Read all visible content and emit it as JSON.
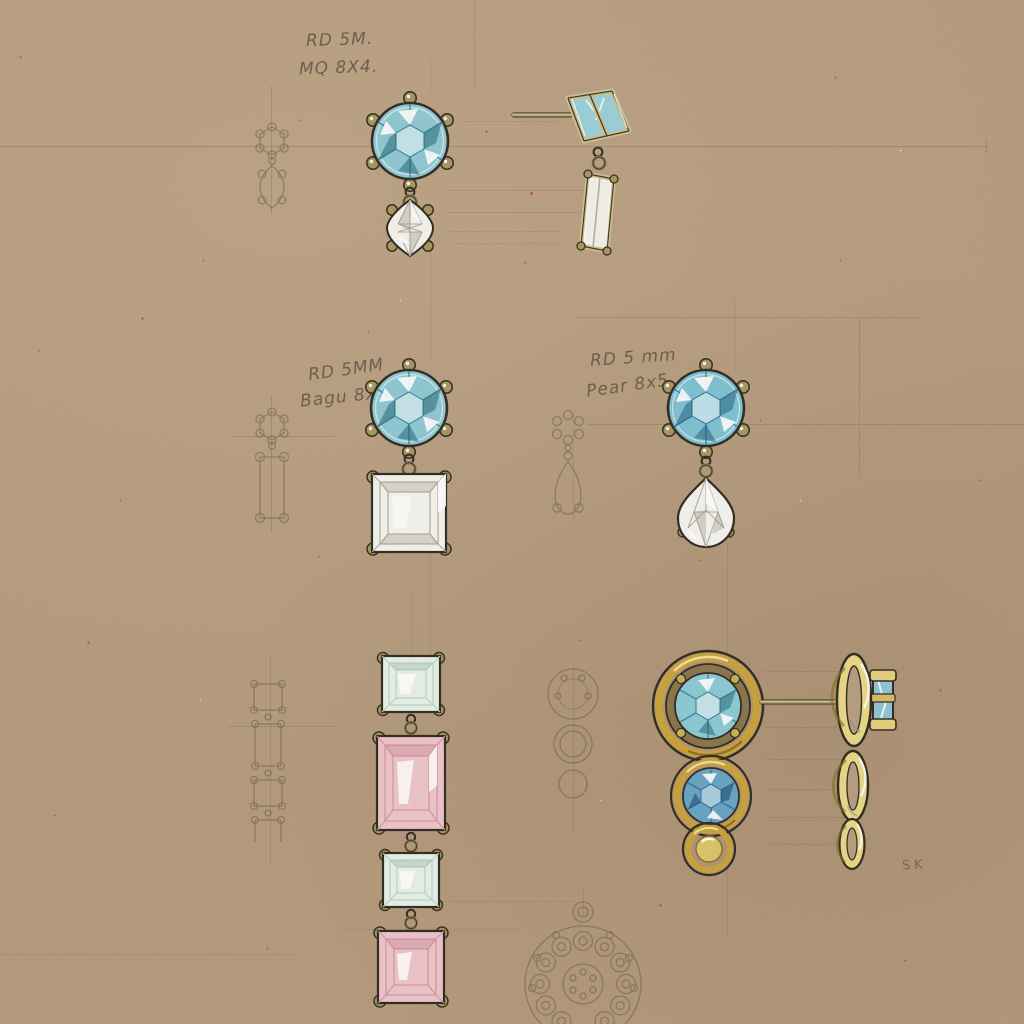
{
  "document": {
    "type": "Hand-painted jewellery earring design sheet on kraft paper",
    "medium": "pencil, ink and gouache"
  },
  "colors": {
    "paper": "#b69b7d",
    "pencil": "#5f584c",
    "ink_outline": "#2e2b23",
    "aquamarine": "#8fc9d4",
    "aquamarine_dark": "#2e7b8e",
    "diamond_white": "#f5f4ef",
    "diamond_shadow": "#b0aea2",
    "metal_khaki": "#a79762",
    "gold": "#caa23c",
    "gold_light": "#f0df9a",
    "pink_baguette": "#eec5cb",
    "mint_square": "#e7f2ea",
    "blue_topaz": "#66a4c4",
    "citrine": "#ddc56c"
  },
  "annotations": {
    "design1": {
      "line1": "RD 5M.",
      "line2": "MQ 8X4."
    },
    "design2": {
      "line1": "RD 5MM",
      "line2": "Bagu 8x4"
    },
    "design3": {
      "line1": "RD 5 mm",
      "line2": "Pear 8x5"
    },
    "signature": "SK"
  },
  "designs": [
    {
      "id": "round-marquise-drop",
      "stones": [
        "5mm round aquamarine stud",
        "8x4 marquise diamond drop"
      ],
      "views": [
        "pencil thumbnail",
        "painted front",
        "painted side"
      ]
    },
    {
      "id": "round-baguette-drop",
      "stones": [
        "5mm round aquamarine stud",
        "8x4 baguette diamond drop"
      ],
      "views": [
        "pencil thumbnail",
        "painted front"
      ]
    },
    {
      "id": "round-pear-drop",
      "stones": [
        "5mm round aquamarine stud",
        "8x5 pear diamond drop"
      ],
      "views": [
        "pencil thumbnail",
        "painted front"
      ]
    },
    {
      "id": "carre-and-pink-baguette-line-drop",
      "stones": [
        "carre step-cut",
        "pink baguette",
        "carre step-cut",
        "pink baguette"
      ],
      "views": [
        "pencil thumbnail",
        "painted front"
      ]
    },
    {
      "id": "graduated-gold-bezel-circles",
      "stones": [
        "aquamarine in double gold halo",
        "blue topaz in gold bezel",
        "gold bead"
      ],
      "views": [
        "pencil thumbnail",
        "painted front",
        "painted side"
      ]
    },
    {
      "id": "round-cluster-pendant",
      "stones": [
        "centre stone with halo of round bezels"
      ],
      "views": [
        "pencil sketch, cropped at sheet edge"
      ]
    }
  ]
}
